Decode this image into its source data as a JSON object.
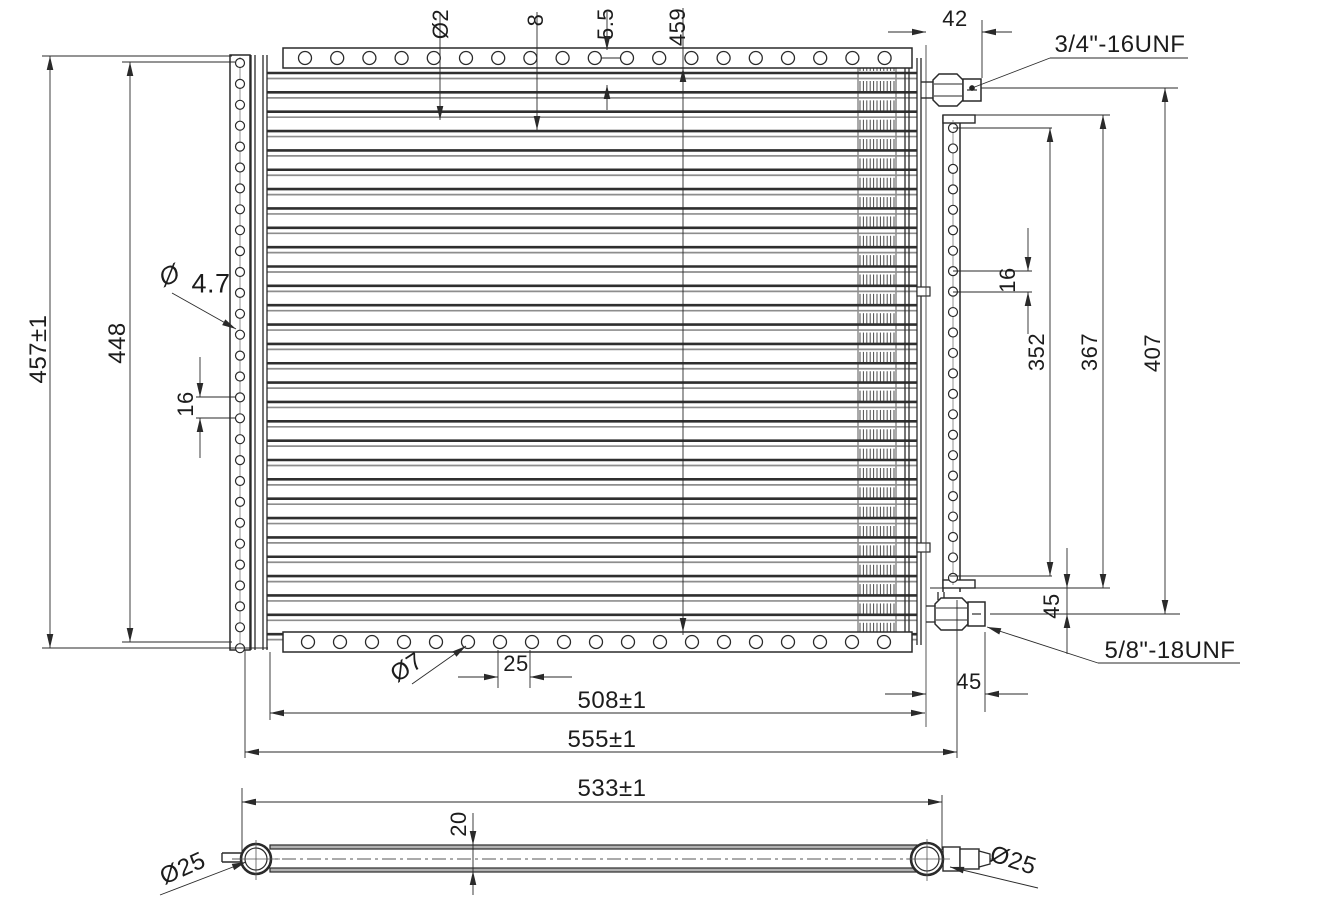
{
  "drawing": {
    "type": "engineering-dimension-drawing",
    "subject": "AC condenser core, front view and bottom view",
    "colors": {
      "line": "#2a2a2a",
      "tube_gray": "#9a9a9a",
      "background": "#ffffff"
    },
    "labels": {
      "tube_hole_dia": "Ø2",
      "tube_pitch": "8",
      "fin_gap": "5.5",
      "core_inner_height": "459",
      "fitting_offset_top": "42",
      "fitting_top_thread": "3/4\"-16UNF",
      "overall_height": "457±1",
      "side_plate_height": "448",
      "side_hole_sym": "Ø",
      "side_hole_dia": "4.7",
      "side_hole_pitch": "16",
      "bracket_hole_pitch": "16",
      "bracket_span_352": "352",
      "bracket_span_367": "367",
      "bracket_span_407": "407",
      "fitting_drop_bottom": "45",
      "fitting_bottom_thread": "5/8\"-18UNF",
      "fitting_offset_bottom": "45",
      "bottom_hole_dia": "Ø7",
      "bottom_hole_pitch": "25",
      "core_width": "508±1",
      "overall_width": "555±1",
      "tube_length": "533±1",
      "core_thickness": "20",
      "pipe_dia_left": "Ø25",
      "pipe_dia_right": "Ø25"
    }
  }
}
